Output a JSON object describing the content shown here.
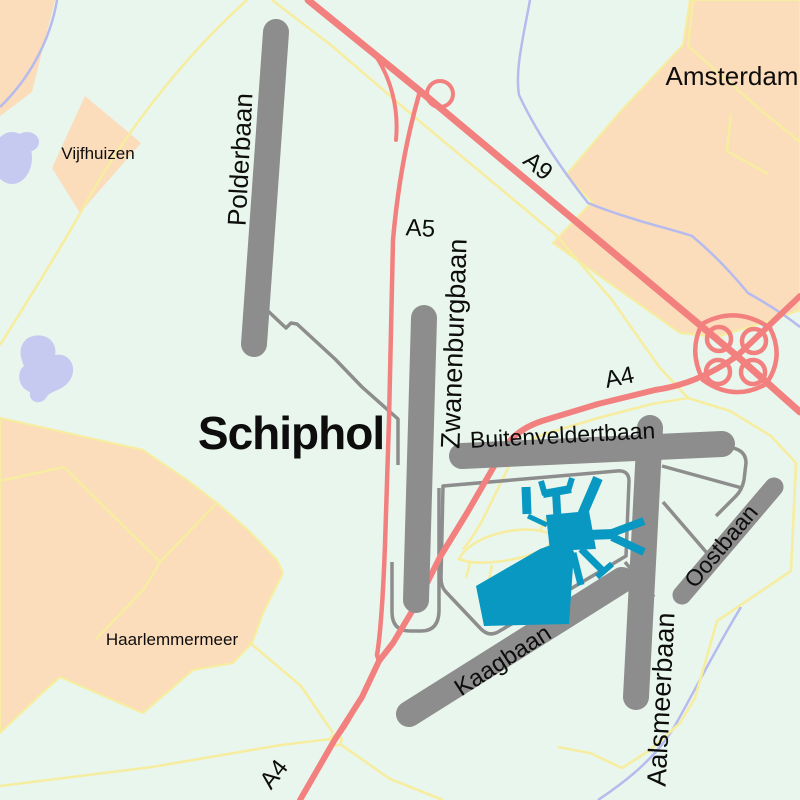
{
  "map": {
    "region_labels": {
      "schiphol": "Schiphol",
      "amsterdam": "Amsterdam",
      "vijfhuizen": "Vijfhuizen",
      "haarlemmermeer": "Haarlemmermeer"
    },
    "runway_labels": {
      "polderbaan": "Polderbaan",
      "zwanenburgbaan": "Zwanenburgbaan",
      "buitenveldertbaan": "Buitenveldertbaan",
      "kaagbaan": "Kaagbaan",
      "aalsmeerbaan": "Aalsmeerbaan",
      "oostbaan": "Oostbaan"
    },
    "highway_labels": {
      "a9": "A9",
      "a5": "A5",
      "a4_east": "A4",
      "a4_south": "A4"
    },
    "colors": {
      "background": "#e9f6ed",
      "urban": "#fbdcbb",
      "runway": "#8d8d8d",
      "taxiway": "#8d8d8d",
      "motorway": "#f2807f",
      "minor_road": "#f6eda0",
      "water_fill": "#c6caf1",
      "water_line": "#b6bbee",
      "terminal": "#0998c2",
      "label": "#0d0d0d"
    }
  }
}
